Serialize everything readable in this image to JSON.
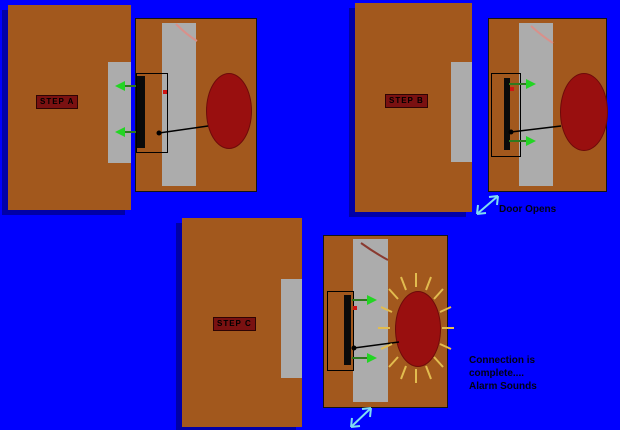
{
  "steps": [
    {
      "label": "STEP A"
    },
    {
      "label": "STEP B",
      "annotation": "Door Opens"
    },
    {
      "label": "STEP C",
      "annotation_lines": [
        "Connection is",
        "complete....",
        "Alarm Sounds"
      ]
    }
  ],
  "colors": {
    "background": "#0000FF",
    "wood_brown": "#A2581D",
    "metal_gray": "#ACACAC",
    "bell_red": "#990F0F",
    "label_red": "#7A1111",
    "switch_black": "#0A0A0A",
    "contact_red": "#D01414",
    "arrow_green_head": "#23D523",
    "arrow_green_line": "#2E7A1F",
    "motion_cyan": "#7FDCF2",
    "ray_yellow": "#E2BC4F",
    "hinge_pink": "#D9908A",
    "shadow_navy": "#0000A8"
  },
  "icons": {
    "magnet_pull_arrow": "green-arrow",
    "door_motion_arrow": "cyan-double-diagonal-arrow",
    "alarm_rays": "yellow-starburst"
  }
}
